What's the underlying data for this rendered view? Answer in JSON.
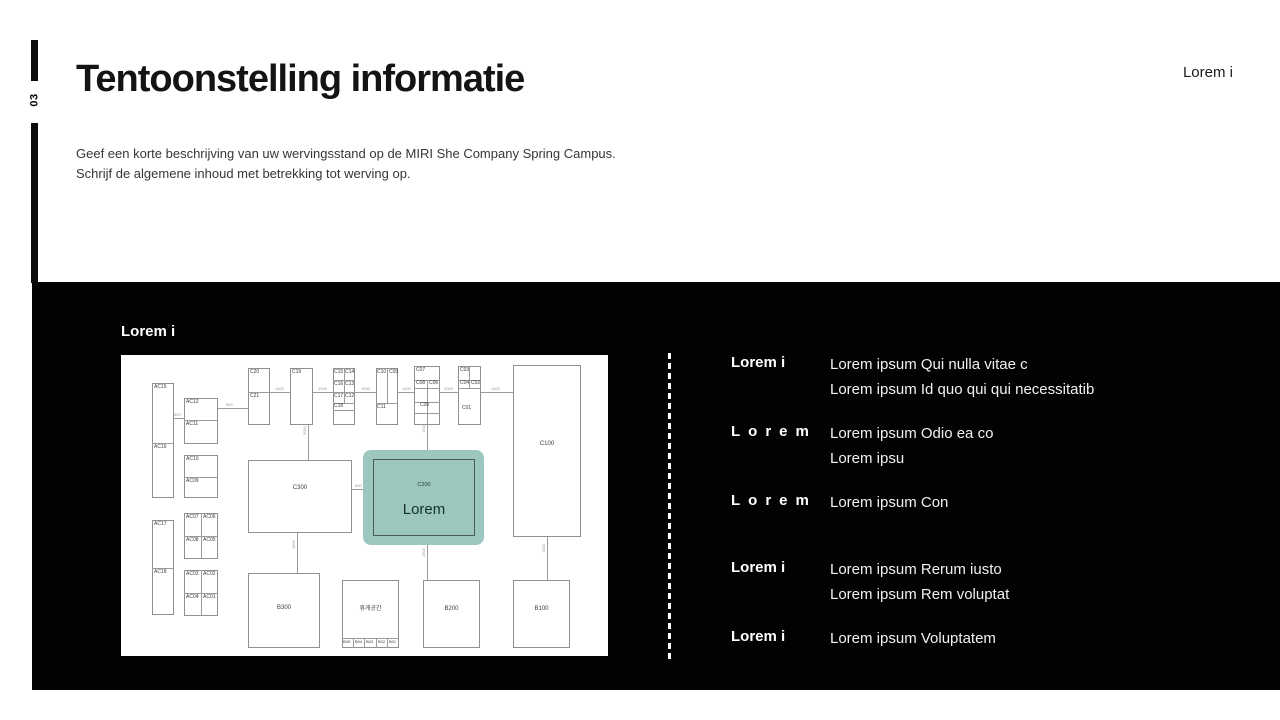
{
  "page_number": "03",
  "header": {
    "title": "Tentoonstelling informatie",
    "description_lines": [
      "Geef een korte beschrijving van uw wervingsstand op de MIRI She Company Spring Campus.",
      "Schrijf de algemene inhoud met betrekking tot werving op."
    ],
    "top_right_label": "Lorem i"
  },
  "colors": {
    "panel_bg": "#020202",
    "highlight": "#9cc7bf",
    "highlight_text": "#15302d"
  },
  "panel": {
    "section_label": "Lorem i",
    "entries": [
      {
        "label": "Lorem i",
        "spaced": false,
        "lines": [
          "Lorem ipsum Qui nulla vitae c",
          "Lorem ipsum Id quo qui qui necessitatib"
        ]
      },
      {
        "label": "Lorem",
        "spaced": true,
        "lines": [
          "Lorem ipsum Odio ea co",
          "Lorem ipsu"
        ]
      },
      {
        "label": "Lorem",
        "spaced": true,
        "lines": [
          "Lorem ipsum Con"
        ]
      },
      {
        "label": "Lorem i",
        "spaced": false,
        "lines": [
          "Lorem ipsum Rerum iusto",
          "Lorem ipsum Rem voluptat"
        ]
      },
      {
        "label": "Lorem i",
        "spaced": false,
        "lines": [
          "Lorem ipsum Voluptatem"
        ]
      }
    ]
  },
  "floorplan": {
    "highlight": {
      "x": 242,
      "y": 95,
      "w": 121,
      "h": 95
    },
    "connectors": [
      {
        "x": 149,
        "y": 37,
        "len": 243,
        "dir": "h"
      },
      {
        "x": 53,
        "y": 63,
        "len": 10,
        "dir": "h"
      },
      {
        "x": 97,
        "y": 53,
        "len": 30,
        "dir": "h"
      },
      {
        "x": 187,
        "y": 70,
        "len": 35,
        "dir": "v"
      },
      {
        "x": 176,
        "y": 178,
        "len": 40,
        "dir": "v"
      },
      {
        "x": 231,
        "y": 134,
        "len": 21,
        "dir": "h"
      },
      {
        "x": 306,
        "y": 70,
        "len": 25,
        "dir": "v"
      },
      {
        "x": 306,
        "y": 190,
        "len": 35,
        "dir": "v"
      },
      {
        "x": 426,
        "y": 182,
        "len": 43,
        "dir": "v"
      }
    ],
    "boxes": [
      {
        "x": 31,
        "y": 28,
        "w": 22,
        "h": 115
      },
      {
        "x": 63,
        "y": 43,
        "w": 34,
        "h": 46
      },
      {
        "x": 63,
        "y": 100,
        "w": 34,
        "h": 43
      },
      {
        "x": 63,
        "y": 158,
        "w": 34,
        "h": 46
      },
      {
        "x": 31,
        "y": 165,
        "w": 22,
        "h": 95
      },
      {
        "x": 63,
        "y": 215,
        "w": 34,
        "h": 46
      },
      {
        "x": 127,
        "y": 13,
        "w": 22,
        "h": 57
      },
      {
        "x": 169,
        "y": 13,
        "w": 23,
        "h": 57
      },
      {
        "x": 212,
        "y": 13,
        "w": 22,
        "h": 57
      },
      {
        "x": 255,
        "y": 13,
        "w": 22,
        "h": 57
      },
      {
        "x": 293,
        "y": 11,
        "w": 26,
        "h": 59
      },
      {
        "x": 337,
        "y": 11,
        "w": 23,
        "h": 59
      },
      {
        "x": 392,
        "y": 10,
        "w": 68,
        "h": 172
      },
      {
        "x": 127,
        "y": 105,
        "w": 104,
        "h": 73
      },
      {
        "x": 252,
        "y": 104,
        "w": 102,
        "h": 77,
        "clear": true
      },
      {
        "x": 127,
        "y": 218,
        "w": 72,
        "h": 75
      },
      {
        "x": 221,
        "y": 225,
        "w": 57,
        "h": 68
      },
      {
        "x": 302,
        "y": 225,
        "w": 57,
        "h": 68
      },
      {
        "x": 392,
        "y": 225,
        "w": 57,
        "h": 68
      }
    ],
    "dividers": [
      {
        "x": 31,
        "y": 88,
        "len": 22,
        "dir": "h"
      },
      {
        "x": 63,
        "y": 65,
        "len": 34,
        "dir": "h"
      },
      {
        "x": 63,
        "y": 122,
        "len": 34,
        "dir": "h"
      },
      {
        "x": 63,
        "y": 181,
        "len": 34,
        "dir": "h"
      },
      {
        "x": 80,
        "y": 158,
        "len": 46,
        "dir": "v"
      },
      {
        "x": 31,
        "y": 213,
        "len": 22,
        "dir": "h"
      },
      {
        "x": 63,
        "y": 238,
        "len": 34,
        "dir": "h"
      },
      {
        "x": 80,
        "y": 215,
        "len": 46,
        "dir": "v"
      },
      {
        "x": 127,
        "y": 37,
        "len": 22,
        "dir": "h"
      },
      {
        "x": 212,
        "y": 25,
        "len": 22,
        "dir": "h"
      },
      {
        "x": 212,
        "y": 37,
        "len": 22,
        "dir": "h"
      },
      {
        "x": 212,
        "y": 48,
        "len": 22,
        "dir": "h"
      },
      {
        "x": 212,
        "y": 55,
        "len": 22,
        "dir": "h"
      },
      {
        "x": 223,
        "y": 13,
        "len": 35,
        "dir": "v"
      },
      {
        "x": 266,
        "y": 13,
        "len": 35,
        "dir": "v"
      },
      {
        "x": 255,
        "y": 48,
        "len": 22,
        "dir": "h"
      },
      {
        "x": 293,
        "y": 25,
        "len": 26,
        "dir": "h"
      },
      {
        "x": 293,
        "y": 33,
        "len": 26,
        "dir": "h"
      },
      {
        "x": 293,
        "y": 47,
        "len": 26,
        "dir": "h"
      },
      {
        "x": 293,
        "y": 58,
        "len": 26,
        "dir": "h"
      },
      {
        "x": 306,
        "y": 25,
        "len": 45,
        "dir": "v"
      },
      {
        "x": 337,
        "y": 25,
        "len": 23,
        "dir": "h"
      },
      {
        "x": 337,
        "y": 33,
        "len": 23,
        "dir": "h"
      },
      {
        "x": 348,
        "y": 11,
        "len": 22,
        "dir": "v"
      },
      {
        "x": 221,
        "y": 283,
        "len": 57,
        "dir": "h"
      },
      {
        "x": 232,
        "y": 283,
        "len": 10,
        "dir": "v"
      },
      {
        "x": 243,
        "y": 283,
        "len": 10,
        "dir": "v"
      },
      {
        "x": 255,
        "y": 283,
        "len": 10,
        "dir": "v"
      },
      {
        "x": 266,
        "y": 283,
        "len": 10,
        "dir": "v"
      }
    ],
    "labels": [
      {
        "t": "AC15",
        "x": 33,
        "y": 30
      },
      {
        "t": "AC16",
        "x": 33,
        "y": 90
      },
      {
        "t": "AC12",
        "x": 65,
        "y": 45
      },
      {
        "t": "AC11",
        "x": 65,
        "y": 67
      },
      {
        "t": "AC10",
        "x": 65,
        "y": 102
      },
      {
        "t": "AC09",
        "x": 65,
        "y": 124
      },
      {
        "t": "AC07",
        "x": 65,
        "y": 160
      },
      {
        "t": "AC06",
        "x": 82,
        "y": 160
      },
      {
        "t": "AC08",
        "x": 65,
        "y": 183
      },
      {
        "t": "AC05",
        "x": 82,
        "y": 183
      },
      {
        "t": "AC17",
        "x": 33,
        "y": 167
      },
      {
        "t": "AC18",
        "x": 33,
        "y": 215
      },
      {
        "t": "AC03",
        "x": 65,
        "y": 217
      },
      {
        "t": "AC02",
        "x": 82,
        "y": 217
      },
      {
        "t": "AC04",
        "x": 65,
        "y": 240
      },
      {
        "t": "AC01",
        "x": 82,
        "y": 240
      },
      {
        "t": "C20",
        "x": 129,
        "y": 15
      },
      {
        "t": "C21",
        "x": 129,
        "y": 39
      },
      {
        "t": "C19",
        "x": 171,
        "y": 15
      },
      {
        "t": "C15",
        "x": 213,
        "y": 15
      },
      {
        "t": "C14",
        "x": 224,
        "y": 15
      },
      {
        "t": "C16",
        "x": 213,
        "y": 27
      },
      {
        "t": "C13",
        "x": 224,
        "y": 27
      },
      {
        "t": "C17",
        "x": 213,
        "y": 39
      },
      {
        "t": "C12",
        "x": 224,
        "y": 39
      },
      {
        "t": "C18",
        "x": 213,
        "y": 49
      },
      {
        "t": "C10",
        "x": 256,
        "y": 15
      },
      {
        "t": "C09",
        "x": 268,
        "y": 15
      },
      {
        "t": "C11",
        "x": 256,
        "y": 50
      },
      {
        "t": "C07",
        "x": 295,
        "y": 13
      },
      {
        "t": "C08",
        "x": 295,
        "y": 26
      },
      {
        "t": "C06",
        "x": 308,
        "y": 26
      },
      {
        "t": "C05",
        "x": 299,
        "y": 48
      },
      {
        "t": "C03",
        "x": 339,
        "y": 13
      },
      {
        "t": "C04",
        "x": 339,
        "y": 26
      },
      {
        "t": "C02",
        "x": 350,
        "y": 26
      },
      {
        "t": "C01",
        "x": 341,
        "y": 51
      },
      {
        "t": "C100",
        "x": 392,
        "y": 86,
        "w": 68,
        "c": 1,
        "fs": 6
      },
      {
        "t": "C300",
        "x": 127,
        "y": 130,
        "w": 104,
        "c": 1,
        "fs": 6
      },
      {
        "t": "B300",
        "x": 127,
        "y": 250,
        "w": 72,
        "c": 1,
        "fs": 6
      },
      {
        "t": "휴게공간",
        "x": 221,
        "y": 251,
        "w": 57,
        "c": 1,
        "fs": 6
      },
      {
        "t": "B200",
        "x": 302,
        "y": 251,
        "w": 57,
        "c": 1,
        "fs": 6
      },
      {
        "t": "B100",
        "x": 392,
        "y": 251,
        "w": 57,
        "c": 1,
        "fs": 6
      },
      {
        "t": "C200",
        "x": 252,
        "y": 128,
        "w": 102,
        "c": 1,
        "fs": 5.5,
        "color": "#1c3734"
      },
      {
        "t": "Lorem",
        "x": 252,
        "y": 147,
        "w": 102,
        "c": 1,
        "fs": 15,
        "color": "#15302d"
      },
      {
        "t": "B05",
        "x": 222,
        "y": 285,
        "fs": 4
      },
      {
        "t": "B04",
        "x": 234,
        "y": 285,
        "fs": 4
      },
      {
        "t": "B03",
        "x": 245,
        "y": 285,
        "fs": 4
      },
      {
        "t": "B02",
        "x": 257,
        "y": 285,
        "fs": 4
      },
      {
        "t": "B01",
        "x": 268,
        "y": 285,
        "fs": 4
      },
      {
        "t": "1000",
        "x": 154,
        "y": 32,
        "fs": 4,
        "color": "#999999"
      },
      {
        "t": "1000",
        "x": 197,
        "y": 32,
        "fs": 4,
        "color": "#999999"
      },
      {
        "t": "1000",
        "x": 240,
        "y": 32,
        "fs": 4,
        "color": "#999999"
      },
      {
        "t": "1000",
        "x": 281,
        "y": 32,
        "fs": 4,
        "color": "#999999"
      },
      {
        "t": "1000",
        "x": 323,
        "y": 32,
        "fs": 4,
        "color": "#999999"
      },
      {
        "t": "1000",
        "x": 370,
        "y": 32,
        "fs": 4,
        "color": "#999999"
      },
      {
        "t": "800",
        "x": 53,
        "y": 58,
        "fs": 4,
        "color": "#999999"
      },
      {
        "t": "600",
        "x": 105,
        "y": 48,
        "fs": 4,
        "color": "#999999"
      },
      {
        "t": "800",
        "x": 234,
        "y": 129,
        "fs": 4,
        "color": "#999999"
      },
      {
        "t": "5000",
        "x": 182,
        "y": 80,
        "fs": 4,
        "color": "#999999",
        "rot": 1
      },
      {
        "t": "1500",
        "x": 171,
        "y": 194,
        "fs": 4,
        "color": "#999999",
        "rot": 1
      },
      {
        "t": "1500",
        "x": 301,
        "y": 78,
        "fs": 4,
        "color": "#999999",
        "rot": 1
      },
      {
        "t": "1500",
        "x": 301,
        "y": 202,
        "fs": 4,
        "color": "#999999",
        "rot": 1
      },
      {
        "t": "1000",
        "x": 421,
        "y": 198,
        "fs": 4,
        "color": "#999999",
        "rot": 1
      }
    ]
  }
}
